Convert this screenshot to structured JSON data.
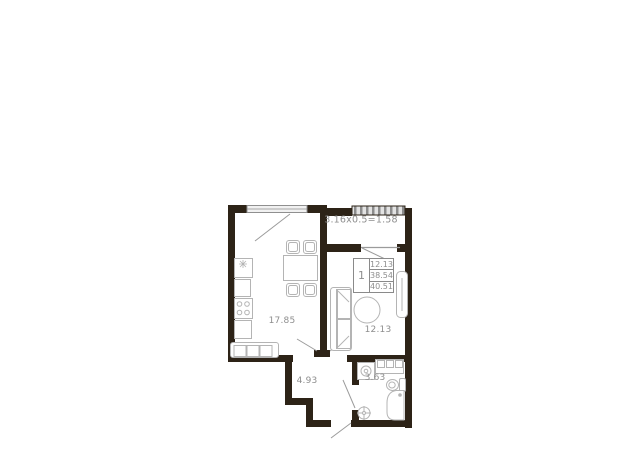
{
  "plan": {
    "legend": {
      "rooms": "1",
      "rows": [
        "12.13",
        "38.54",
        "40.51"
      ]
    },
    "labels": {
      "balcony_formula": "3.16x0.5=1.58",
      "kitchen": "17.85",
      "room": "12.13",
      "hallway": "4.93",
      "bathroom": "3.63"
    },
    "colors": {
      "wall": "#2d2317",
      "furniture": "#b4b4b4",
      "text": "#8e8e8e"
    }
  }
}
